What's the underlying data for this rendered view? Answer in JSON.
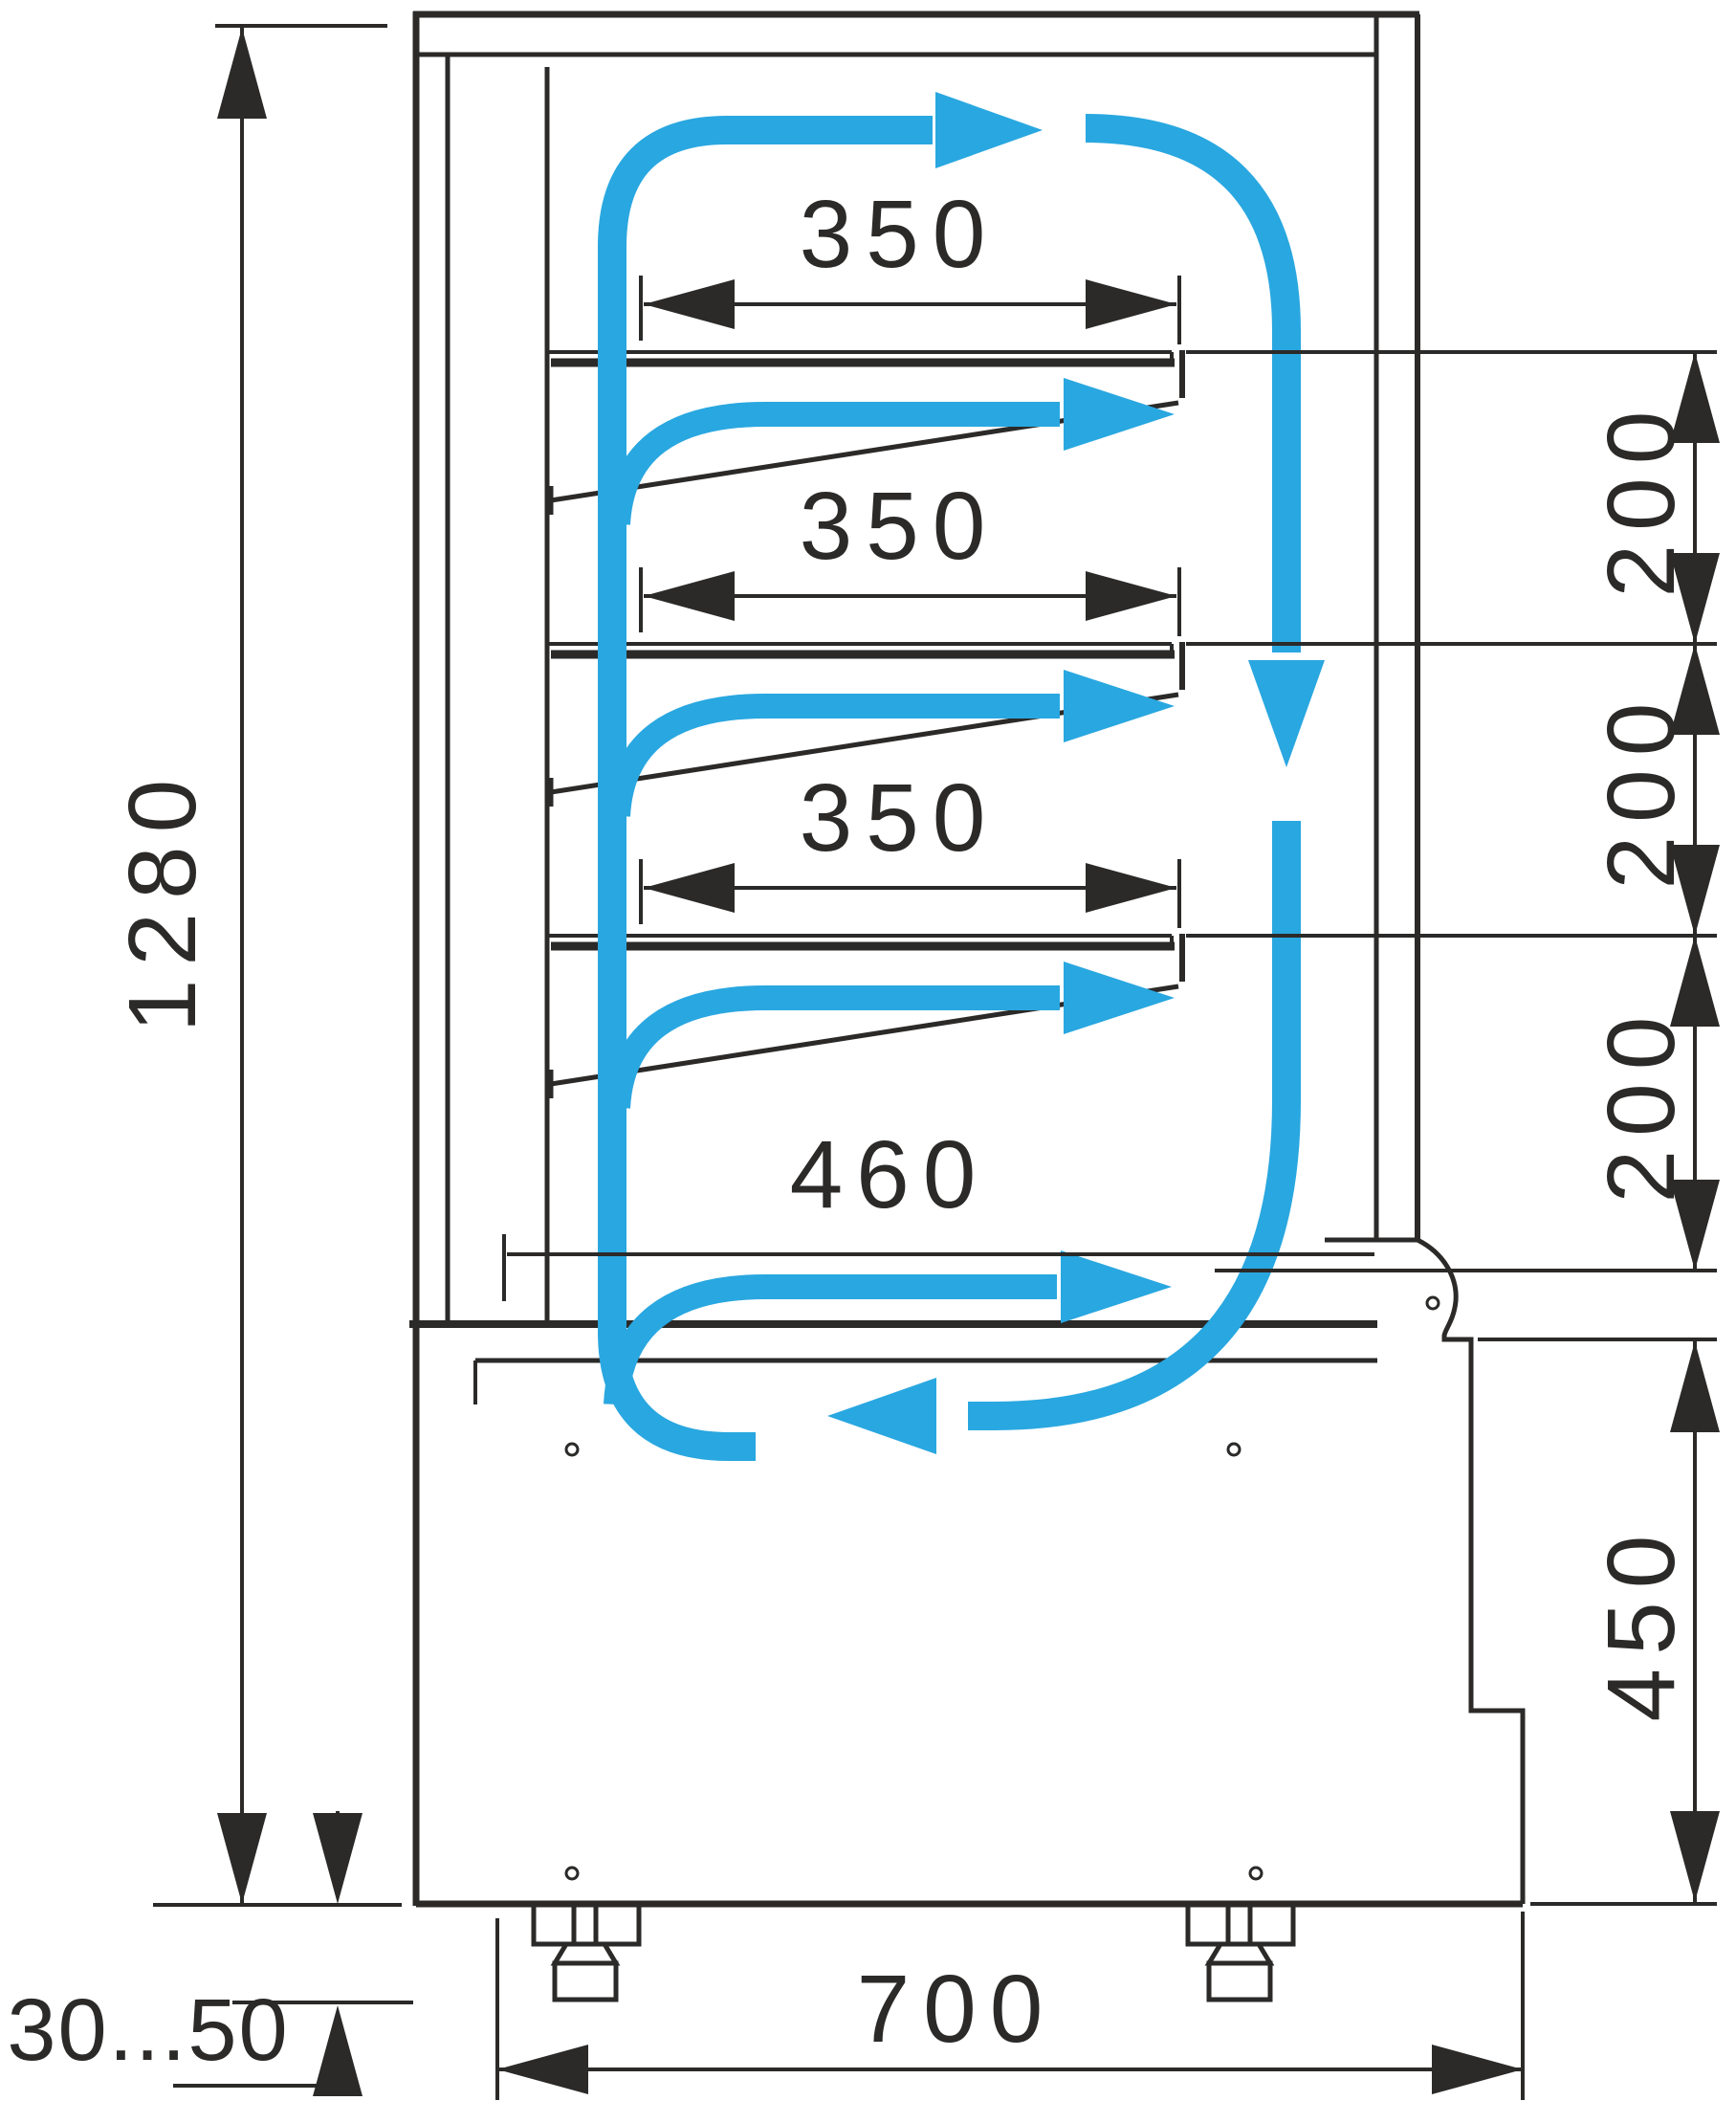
{
  "drawing": {
    "title": "refrigerated-display-case-side-section",
    "type": "dimensioned technical side-section with air circulation",
    "colors": {
      "line": "#2b2a29",
      "airflow": "#29a7e0",
      "background": "#ffffff"
    },
    "dimensions": {
      "overall_height": "1280",
      "shelf_depths": [
        "350",
        "350",
        "350"
      ],
      "shelf_spacings": [
        "200",
        "200",
        "200"
      ],
      "bottom_shelf_depth": "460",
      "base_height": "450",
      "overall_depth": "700",
      "leg_adjustment_range": "30...50"
    },
    "airflow_arrows": [
      "top-supply-arrow",
      "front-downflow-arrow",
      "return-flow-arrow",
      "shelf-jet-1",
      "shelf-jet-2",
      "shelf-jet-3",
      "bottom-shelf-jet"
    ]
  }
}
